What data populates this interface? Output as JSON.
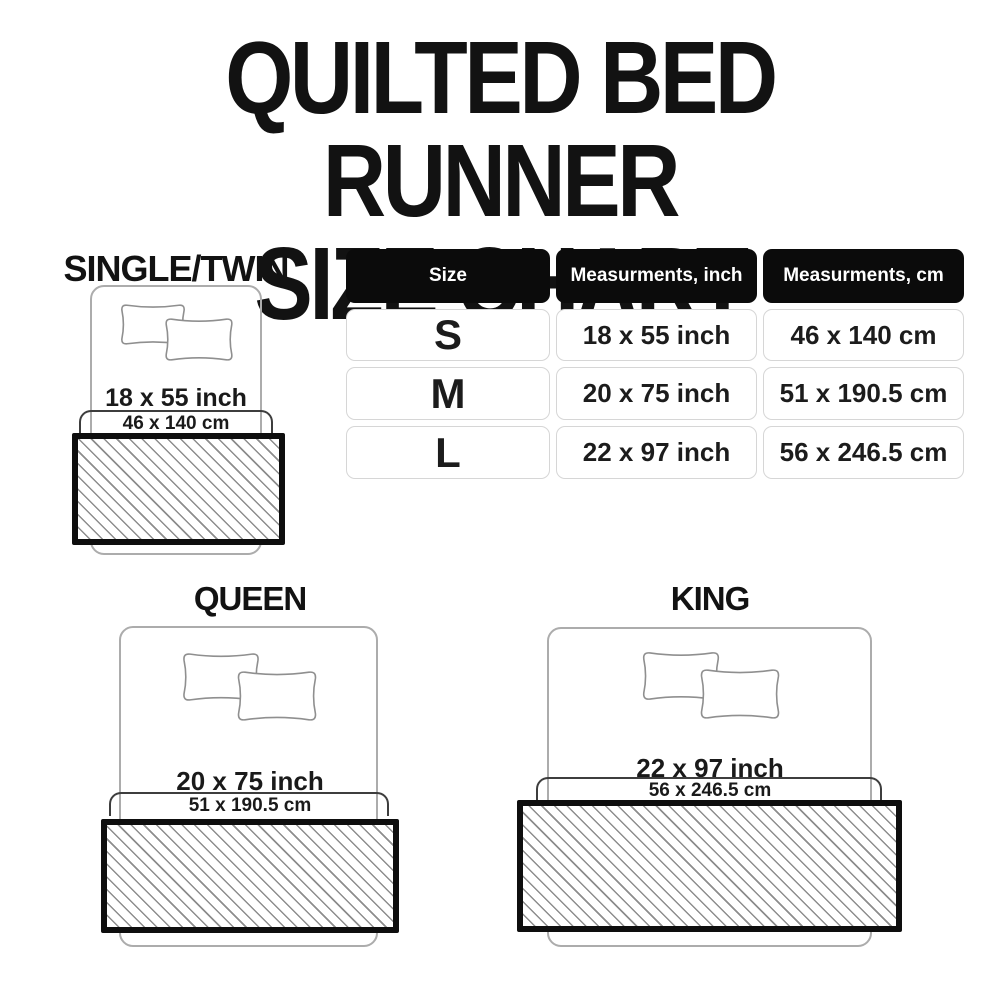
{
  "title": {
    "line1": "QUILTED BED RUNNER",
    "line2": "SIZE CHART"
  },
  "size_table": {
    "headers": [
      "Size",
      "Measurments, inch",
      "Measurments, cm"
    ],
    "rows": [
      [
        "S",
        "18 x 55 inch",
        "46 x 140 cm"
      ],
      [
        "M",
        "20 x 75 inch",
        "51 x 190.5 cm"
      ],
      [
        "L",
        "22 x 97 inch",
        "56 x 246.5 cm"
      ]
    ]
  },
  "diagrams": {
    "single_twin": {
      "label": "SINGLE/TWIN",
      "inch": "18 x 55 inch",
      "cm": "46 x 140 cm"
    },
    "queen": {
      "label": "QUEEN",
      "inch": "20 x 75 inch",
      "cm": "51 x 190.5 cm"
    },
    "king": {
      "label": "KING",
      "inch": "22 x 97 inch",
      "cm": "56 x 246.5 cm"
    }
  },
  "colors": {
    "background": "#ffffff",
    "text": "#151515",
    "table_header_bg": "#0b0b0b",
    "table_header_text": "#ffffff",
    "table_cell_border": "#d6d6d6",
    "runner_border": "#0e0e0e",
    "hatch_line": "#8d8d8d",
    "bed_outline": "#acacac",
    "bracket_line": "#3d3d3d"
  }
}
